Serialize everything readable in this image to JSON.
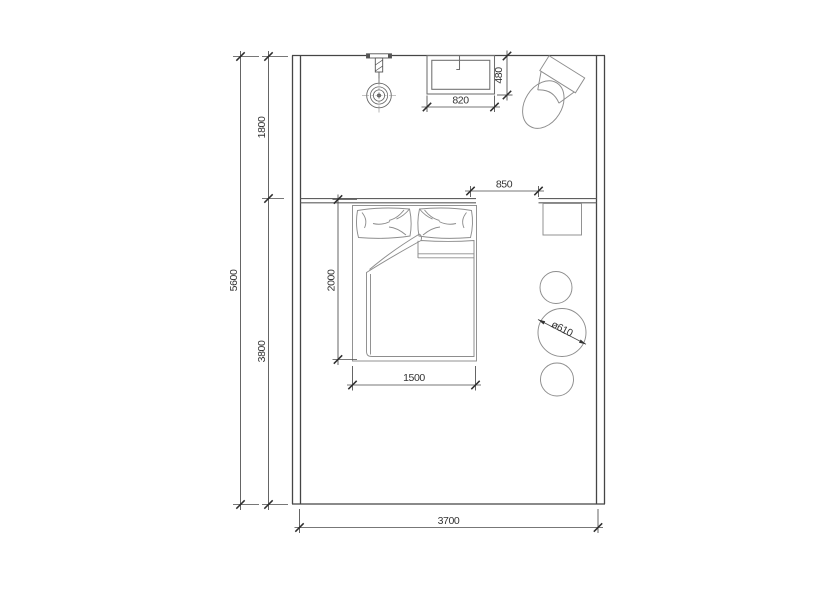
{
  "drawing": {
    "type": "bedroom-floor-plan",
    "colors": {
      "background": "#ffffff",
      "wall_line": "#454545",
      "furniture_line": "#8d8d8d",
      "dimension_line": "#4a4a4a",
      "text": "#333333"
    },
    "dimensions": {
      "total_depth": "5600",
      "upper_zone_depth": "1800",
      "lower_zone_depth": "3800",
      "room_width": "3700",
      "window_width": "820",
      "window_depth": "480",
      "opening_width": "850",
      "bed_length": "2000",
      "bed_width": "1500",
      "stool_diameter": "ø610"
    }
  }
}
